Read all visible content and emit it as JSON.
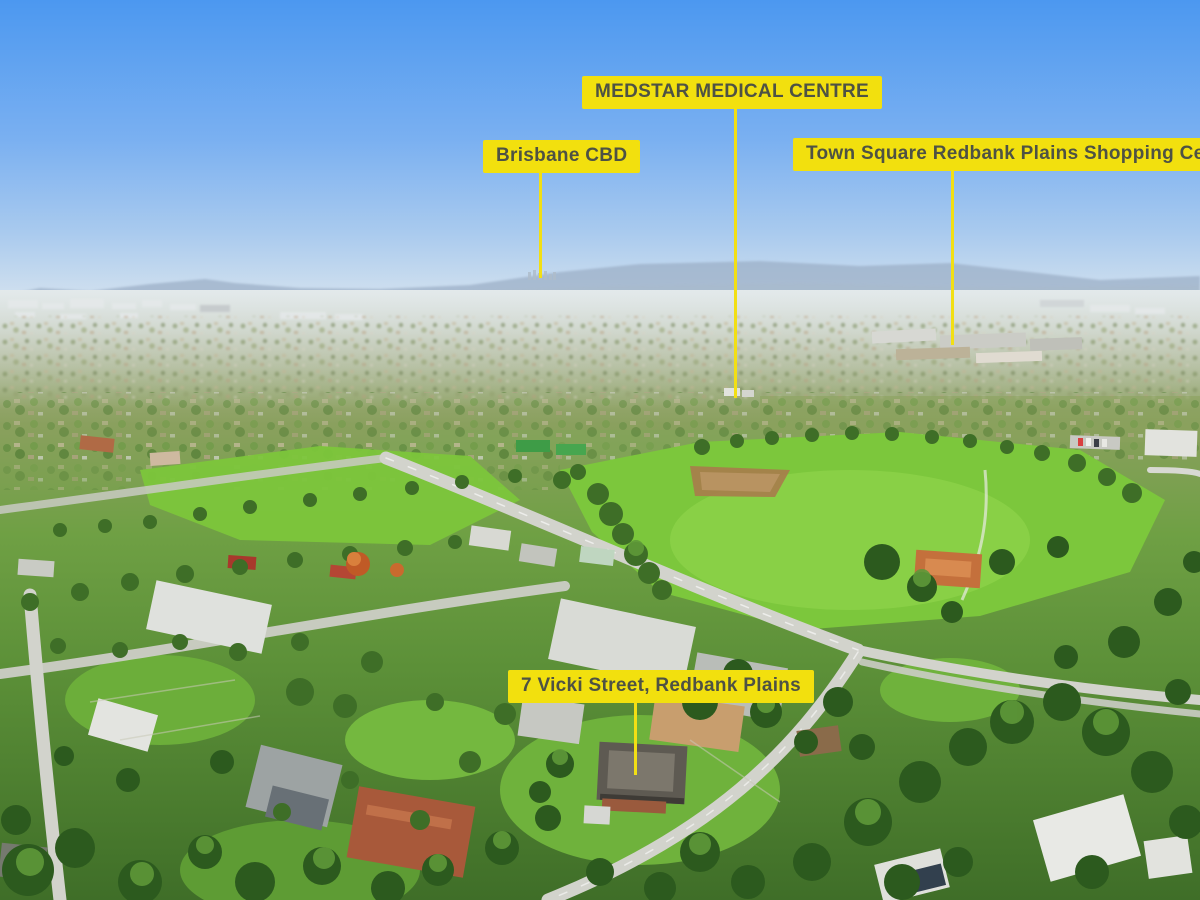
{
  "photo": {
    "description": "Aerial drone photograph of a leafy residential suburb with bright green parkland, winding streets, distant hazy hills and a blue sky",
    "colors": {
      "label_bg": "#F2E00E",
      "label_text": "#4E5244",
      "pointer_line": "#F2DF14",
      "sky_top": "#4C98F0",
      "sky_horizon": "#D9E5EF",
      "parkland_green": "#7CC73C",
      "foreground_green": "#4E8032"
    }
  },
  "callouts": [
    {
      "id": "medstar-medical-centre",
      "label": "MEDSTAR MEDICAL CENTRE"
    },
    {
      "id": "brisbane-cbd",
      "label": "Brisbane CBD"
    },
    {
      "id": "town-square-redbank-plains",
      "label": "Town Square Redbank Plains Shopping Centre"
    },
    {
      "id": "vicki-street-property",
      "label": "7 Vicki Street, Redbank Plains"
    }
  ]
}
